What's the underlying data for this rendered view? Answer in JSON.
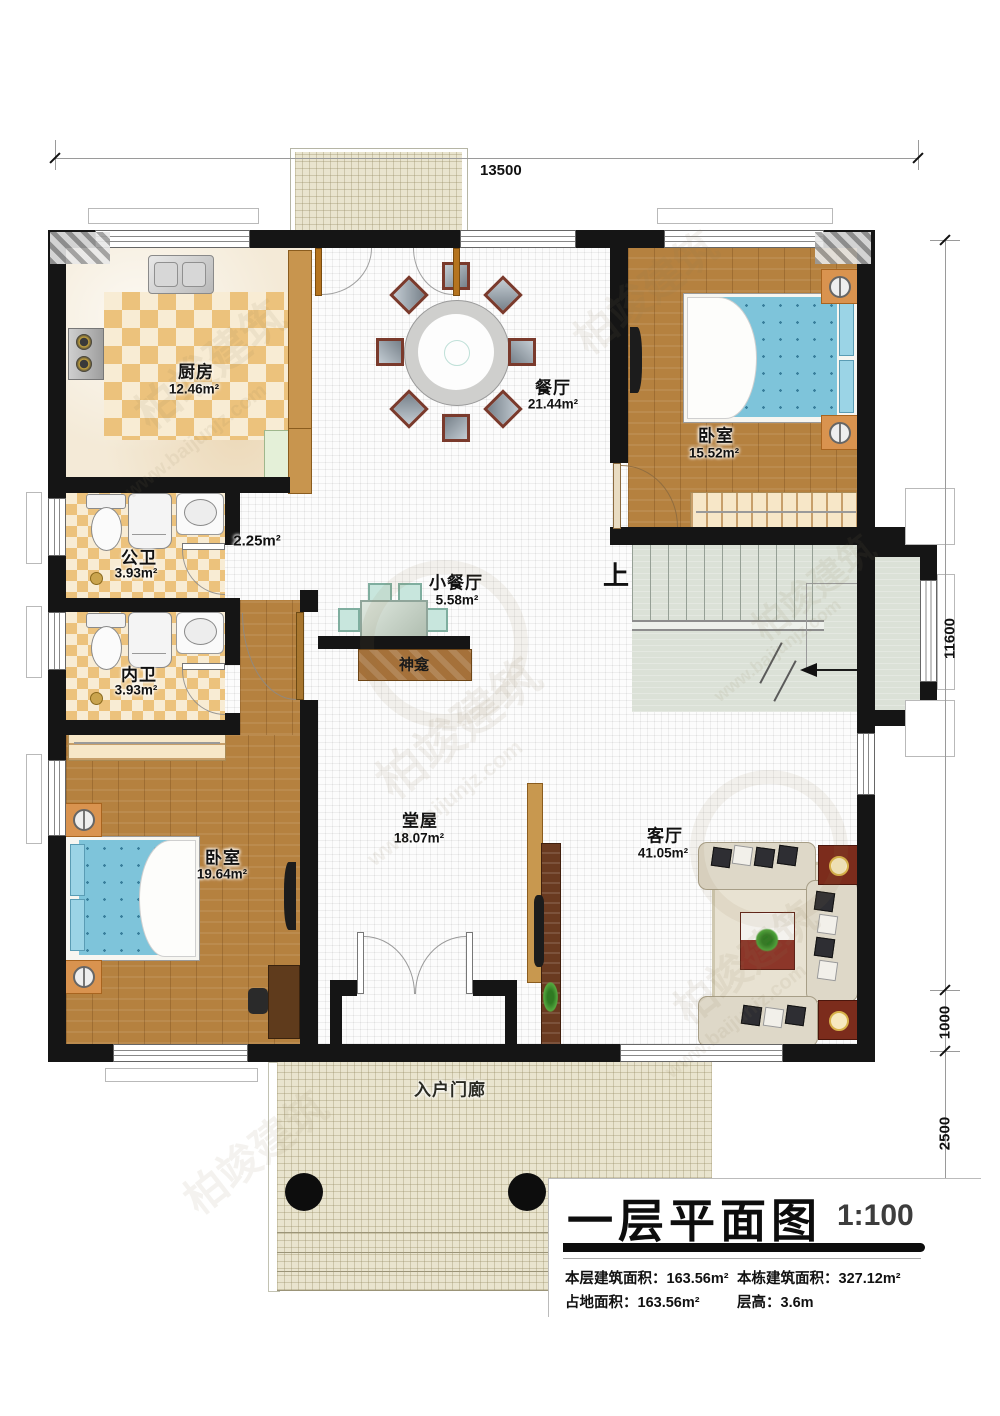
{
  "dimensions": {
    "top": "13500",
    "right_upper": "11600",
    "right_mid": "1000",
    "right_lower": "2500"
  },
  "rooms": {
    "kitchen": {
      "name": "厨房",
      "area": "12.46m²"
    },
    "dining": {
      "name": "餐厅",
      "area": "21.44m²"
    },
    "bedroom1": {
      "name": "卧室",
      "area": "15.52m²"
    },
    "hallway": {
      "area": "2.25m²"
    },
    "public_bath": {
      "name": "公卫",
      "area": "3.93m²"
    },
    "small_dining": {
      "name": "小餐厅",
      "area": "5.58m²"
    },
    "private_bath": {
      "name": "内卫",
      "area": "3.93m²"
    },
    "shrine": {
      "name": "神龛"
    },
    "stairs": {
      "up_label": "上"
    },
    "bedroom2": {
      "name": "卧室",
      "area": "19.64m²"
    },
    "main_hall": {
      "name": "堂屋",
      "area": "18.07m²"
    },
    "living": {
      "name": "客厅",
      "area": "41.05m²"
    },
    "porch": {
      "name": "入户门廊"
    }
  },
  "title_block": {
    "title": "一层平面图",
    "scale": "1:100",
    "stats": [
      {
        "label": "本层建筑面积：",
        "value": "163.56m²"
      },
      {
        "label": "本栋建筑面积：",
        "value": "327.12m²"
      },
      {
        "label": "占地面积：",
        "value": "163.56m²"
      },
      {
        "label": "层高：",
        "value": "3.6m"
      }
    ]
  },
  "watermark": {
    "brand": "柏竣建筑",
    "url": "www.baijunjz.com"
  },
  "colors": {
    "wall": "#151515",
    "wood": "#b5813f",
    "bed": "#7ec4da",
    "accent_checker": "#ecc27c"
  }
}
